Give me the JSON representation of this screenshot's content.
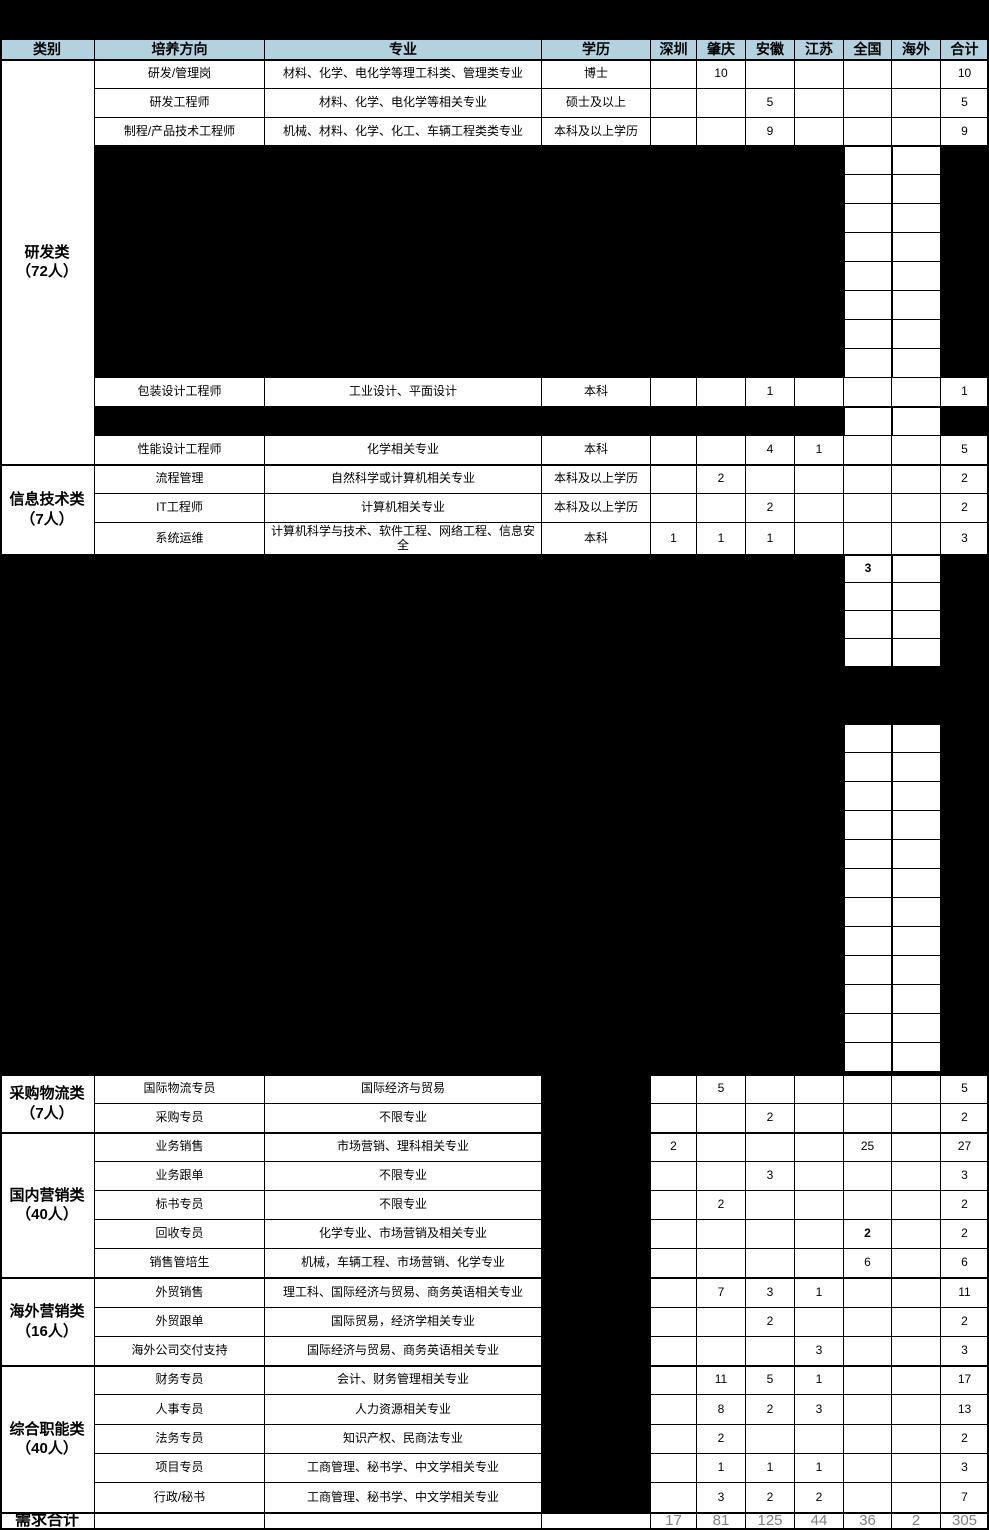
{
  "header": {
    "columns": [
      "类别",
      "培养方向",
      "专业",
      "学历",
      "深圳",
      "肇庆",
      "安徽",
      "江苏",
      "全国",
      "海外",
      "合计"
    ]
  },
  "categories": [
    {
      "label": "研发类",
      "sub": "（72人）"
    },
    {
      "label": "信息技术类",
      "sub": "（7人）"
    },
    {
      "label": "采购物流类",
      "sub": "（7人）"
    },
    {
      "label": "国内营销类",
      "sub": "（40人）"
    },
    {
      "label": "海外营销类",
      "sub": "（16人）"
    },
    {
      "label": "综合职能类",
      "sub": "（40人）"
    }
  ],
  "rows": [
    {
      "direction": "研发/管理岗",
      "major": "材料、化学、电化学等理工科类、管理类专业",
      "degree": "博士",
      "shenzhen": "",
      "zhaoqing": "10",
      "anhui": "",
      "jiangsu": "",
      "national": "",
      "overseas": "",
      "total": "10"
    },
    {
      "direction": "研发工程师",
      "major": "材料、化学、电化学等相关专业",
      "degree": "硕士及以上",
      "shenzhen": "",
      "zhaoqing": "",
      "anhui": "5",
      "jiangsu": "",
      "national": "",
      "overseas": "",
      "total": "5"
    },
    {
      "direction": "制程/产品技术工程师",
      "major": "机械、材料、化学、化工、车辆工程类类专业",
      "degree": "本科及以上学历",
      "shenzhen": "",
      "zhaoqing": "",
      "anhui": "9",
      "jiangsu": "",
      "national": "",
      "overseas": "",
      "total": "9"
    },
    {
      "direction": "包装设计工程师",
      "major": "工业设计、平面设计",
      "degree": "本科",
      "shenzhen": "",
      "zhaoqing": "",
      "anhui": "1",
      "jiangsu": "",
      "national": "",
      "overseas": "",
      "total": "1"
    },
    {
      "direction": "性能设计工程师",
      "major": "化学相关专业",
      "degree": "本科",
      "shenzhen": "",
      "zhaoqing": "",
      "anhui": "4",
      "jiangsu": "1",
      "national": "",
      "overseas": "",
      "total": "5"
    },
    {
      "direction": "流程管理",
      "major": "自然科学或计算机相关专业",
      "degree": "本科及以上学历",
      "shenzhen": "",
      "zhaoqing": "2",
      "anhui": "",
      "jiangsu": "",
      "national": "",
      "overseas": "",
      "total": "2"
    },
    {
      "direction": "IT工程师",
      "major": "计算机相关专业",
      "degree": "本科及以上学历",
      "shenzhen": "",
      "zhaoqing": "",
      "anhui": "2",
      "jiangsu": "",
      "national": "",
      "overseas": "",
      "total": "2"
    },
    {
      "direction": "系统运维",
      "major": "计算机科学与技术、软件工程、网络工程、信息安全",
      "degree": "本科",
      "shenzhen": "1",
      "zhaoqing": "1",
      "anhui": "1",
      "jiangsu": "",
      "national": "",
      "overseas": "",
      "total": "3"
    },
    {
      "direction": "国际物流专员",
      "major": "国际经济与贸易",
      "degree": "",
      "shenzhen": "",
      "zhaoqing": "5",
      "anhui": "",
      "jiangsu": "",
      "national": "",
      "overseas": "",
      "total": "5"
    },
    {
      "direction": "采购专员",
      "major": "不限专业",
      "degree": "",
      "shenzhen": "",
      "zhaoqing": "",
      "anhui": "2",
      "jiangsu": "",
      "national": "",
      "overseas": "",
      "total": "2"
    },
    {
      "direction": "业务销售",
      "major": "市场营销、理科相关专业",
      "degree": "",
      "shenzhen": "2",
      "zhaoqing": "",
      "anhui": "",
      "jiangsu": "",
      "national": "25",
      "overseas": "",
      "total": "27"
    },
    {
      "direction": "业务跟单",
      "major": "不限专业",
      "degree": "",
      "shenzhen": "",
      "zhaoqing": "",
      "anhui": "3",
      "jiangsu": "",
      "national": "",
      "overseas": "",
      "total": "3"
    },
    {
      "direction": "标书专员",
      "major": "不限专业",
      "degree": "",
      "shenzhen": "",
      "zhaoqing": "2",
      "anhui": "",
      "jiangsu": "",
      "national": "",
      "overseas": "",
      "total": "2"
    },
    {
      "direction": "回收专员",
      "major": "化学专业、市场营销及相关专业",
      "degree": "",
      "shenzhen": "",
      "zhaoqing": "",
      "anhui": "",
      "jiangsu": "",
      "national": "2",
      "overseas": "",
      "total": "2",
      "bold_cols": [
        "national"
      ]
    },
    {
      "direction": "销售管培生",
      "major": "机械，车辆工程、市场营销、化学专业",
      "degree": "",
      "shenzhen": "",
      "zhaoqing": "",
      "anhui": "",
      "jiangsu": "",
      "national": "6",
      "overseas": "",
      "total": "6"
    },
    {
      "direction": "外贸销售",
      "major": "理工科、国际经济与贸易、商务英语相关专业",
      "degree": "",
      "shenzhen": "",
      "zhaoqing": "7",
      "anhui": "3",
      "jiangsu": "1",
      "national": "",
      "overseas": "",
      "total": "11"
    },
    {
      "direction": "外贸跟单",
      "major": "国际贸易，经济学相关专业",
      "degree": "",
      "shenzhen": "",
      "zhaoqing": "",
      "anhui": "2",
      "jiangsu": "",
      "national": "",
      "overseas": "",
      "total": "2"
    },
    {
      "direction": "海外公司交付支持",
      "major": "国际经济与贸易、商务英语相关专业",
      "degree": "",
      "shenzhen": "",
      "zhaoqing": "",
      "anhui": "",
      "jiangsu": "3",
      "national": "",
      "overseas": "",
      "total": "3"
    },
    {
      "direction": "财务专员",
      "major": "会计、财务管理相关专业",
      "degree": "",
      "shenzhen": "",
      "zhaoqing": "11",
      "anhui": "5",
      "jiangsu": "1",
      "national": "",
      "overseas": "",
      "total": "17"
    },
    {
      "direction": "人事专员",
      "major": "人力资源相关专业",
      "degree": "",
      "shenzhen": "",
      "zhaoqing": "8",
      "anhui": "2",
      "jiangsu": "3",
      "national": "",
      "overseas": "",
      "total": "13"
    },
    {
      "direction": "法务专员",
      "major": "知识产权、民商法专业",
      "degree": "",
      "shenzhen": "",
      "zhaoqing": "2",
      "anhui": "",
      "jiangsu": "",
      "national": "",
      "overseas": "",
      "total": "2"
    },
    {
      "direction": "项目专员",
      "major": "工商管理、秘书学、中文学相关专业",
      "degree": "",
      "shenzhen": "",
      "zhaoqing": "1",
      "anhui": "1",
      "jiangsu": "1",
      "national": "",
      "overseas": "",
      "total": "3"
    },
    {
      "direction": "行政/秘书",
      "major": "工商管理、秘书学、中文学相关专业",
      "degree": "",
      "shenzhen": "",
      "zhaoqing": "3",
      "anhui": "2",
      "jiangsu": "2",
      "national": "",
      "overseas": "",
      "total": "7"
    }
  ],
  "totals": {
    "label": "需求合计",
    "values": {
      "shenzhen": "17",
      "zhaoqing": "81",
      "anhui": "125",
      "jiangsu": "44",
      "national": "36",
      "overseas": "2",
      "total": "305"
    }
  },
  "blackout": {
    "visible_value": "3"
  },
  "colors": {
    "header_bg": "#B3D1DE",
    "redaction": "#000000",
    "grid": "#000000",
    "totals_text": "#808080"
  }
}
